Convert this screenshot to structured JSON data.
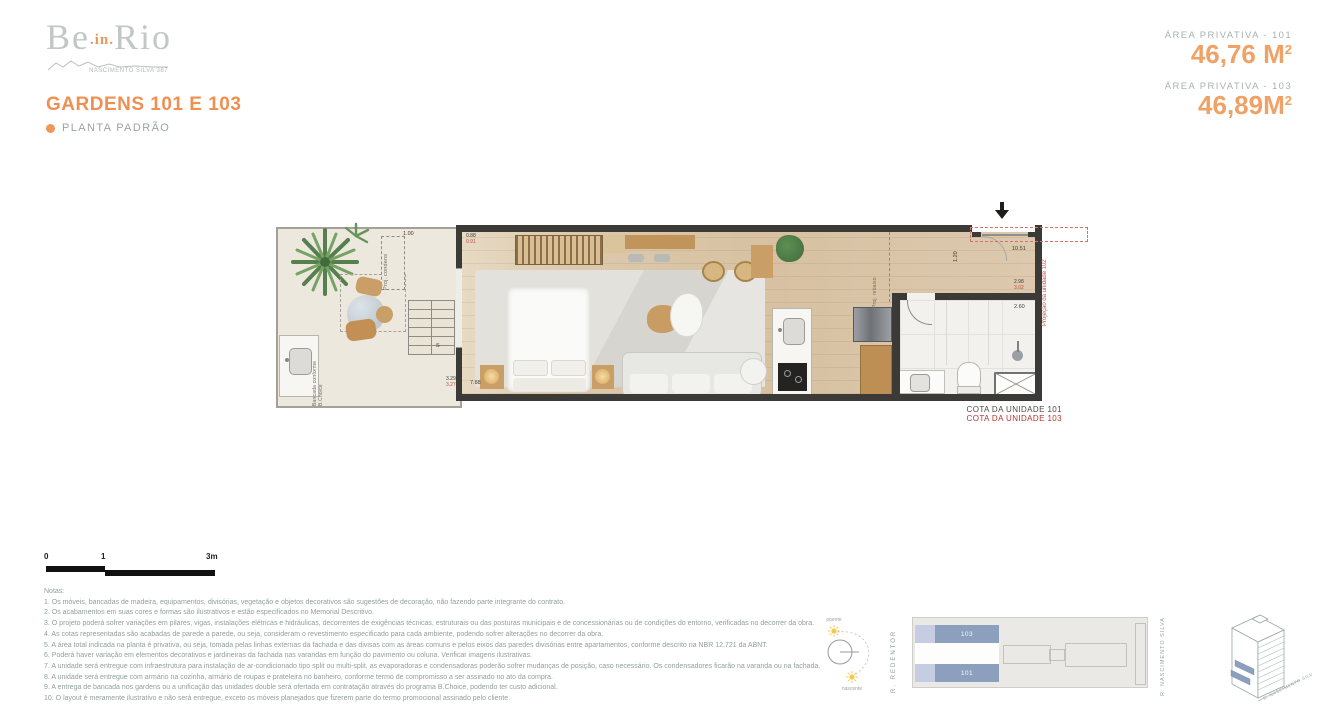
{
  "brand": {
    "be": "Be",
    "in": ".in.",
    "rio": "Rio",
    "subtitle": "NASCIMENTO SILVA 387"
  },
  "header": {
    "title": "GARDENS 101 E 103",
    "subtitle": "PLANTA PADRÃO"
  },
  "areas": {
    "label_101": "ÁREA PRIVATIVA - 101",
    "value_101": "46,76 M",
    "sup_101": "2",
    "label_103": "ÁREA PRIVATIVA - 103",
    "value_103": "46,89M",
    "sup_103": "2"
  },
  "plan": {
    "labels": {
      "proj_condens": "Proj. condens",
      "proj_rebaixo": "Proj. rebaixo",
      "bancada_1": "Bancada conforme",
      "bancada_2": "B.Choice",
      "proj_unidade": "Projeção da unidade 102",
      "stairs": "S"
    },
    "dims": {
      "garden_top": "1.00",
      "garden_bottom_101": "3.29",
      "garden_bottom_103": "3.27",
      "living_length": "7.88",
      "pair_bed_101": "0.88",
      "pair_bed_103": "0.91",
      "entry_width": "1.20",
      "unit_length": "10.51",
      "pair_bath_101": "2.98",
      "pair_bath_103": "3.02",
      "bath_width": "2.60",
      "bath_counter": "1.62"
    },
    "cota_101": "COTA DA UNIDADE 101",
    "cota_103": "COTA DA UNIDADE 103"
  },
  "scalebar": {
    "zero": "0",
    "one": "1",
    "three": "3m"
  },
  "notes": {
    "title": "Notas:",
    "lines": [
      "1. Os móveis, bancadas de madeira, equipamentos, divisórias, vegetação e objetos decorativos são sugestões de decoração, não fazendo parte integrante do contrato.",
      "2. Os acabamentos em suas cores e formas são ilustrativos e estão especificados no Memorial Descritivo.",
      "3. O projeto poderá sofrer variações em pilares, vigas, instalações elétricas e hidráulicas, decorrentes de exigências técnicas, estruturais ou das posturas municipais e de concessionárias ou de condições do entorno, verificadas no decorrer da obra.",
      "4. As cotas representadas são acabadas de parede a parede, ou seja, consideram o revestimento especificado para cada ambiente, podendo sofrer alterações no decorrer da obra.",
      "5. A área total indicada na planta é privativa, ou seja, tomada pelas linhas externas da fachada e das divisas com as áreas comuns e pelos eixos das paredes divisórias entre apartamentos, conforme descrito na NBR 12.721 da ABNT.",
      "6. Poderá haver variação em elementos decorativos e jardineiras da fachada nas varandas em função do pavimento ou coluna. Verificar imagens ilustrativas.",
      "7. A unidade será entregue com infraestrutura para instalação de ar-condicionado tipo split ou multi-split, as evaporadoras e condensadoras poderão sofrer mudanças de posição, caso necessário. Os condensadores ficarão na varanda ou na fachada.",
      "8. A unidade será entregue com armário na cozinha, armário de roupas e prateleira no banheiro, conforme termo de compromisso a ser assinado no ato da compra.",
      "9. A entrega de bancada nos gardens ou a unificação das unidades double será ofertada em contratação através do programa B.Choice, podendo ter custo adicional.",
      "10. O layout é meramente ilustrativo e não será entregue, exceto os móveis planejados que fizerem parte do termo promocional assinado pelo cliente."
    ]
  },
  "diagrams": {
    "sun": {
      "poente": "poente",
      "nascente": "nascente"
    },
    "street_left": "R. REDENTOR",
    "street_right": "R. NASCIMENTO SILVA",
    "keyplan": {
      "unit_top": "103",
      "unit_bottom": "101"
    },
    "building_street": "R. NASCIMENTO SILVA"
  },
  "colors": {
    "accent": "#ED9658",
    "red": "#B5352F",
    "wall": "#3B3A37",
    "unit_blue": "#8CA0BE",
    "text_gray": "#9AA4A4",
    "notes_gray": "#90A09D"
  }
}
